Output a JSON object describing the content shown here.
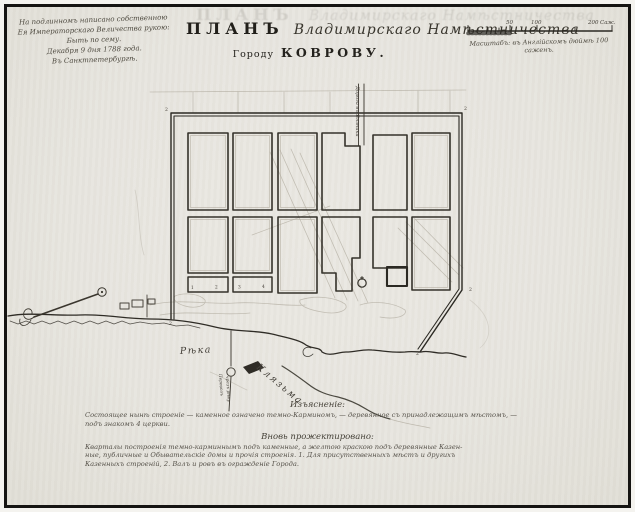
{
  "colors": {
    "paper": "#e9e7e1",
    "ink": "#2b2923",
    "faint": "#a39d8f",
    "frame": "#151412"
  },
  "imperial_note": {
    "lines": [
      "На подлинномъ написано собственною",
      "Ея Императорскаго Величества рукою:",
      "Быть по сему.",
      "Декабря 9 дня 1788 года.",
      "Въ Санктпетербургѣ."
    ]
  },
  "title": {
    "plan": "ПЛАНЪ",
    "script": "Владимирскаго Намѣстничества",
    "city_prefix": "Городу",
    "city": "КОВРОВУ."
  },
  "scale_bar": {
    "labels": [
      "50",
      "100",
      "200"
    ],
    "unit": "Саж.",
    "caption": "Масштабъ: въ Англійскомъ дюймѣ 100 саженъ."
  },
  "map_labels": {
    "road_north": "Дорога въ Вязники",
    "river_word": "Рѣка",
    "river_name": "Клязьма",
    "ferry_line1": "Перевозъ",
    "ferry_line2": "чрезъ рѣку",
    "corner_mark": "2",
    "block_numbers": [
      "1",
      "2",
      "3",
      "4"
    ]
  },
  "legend": {
    "heading_existing": "Изъясненіе:",
    "existing": [
      "Состоящее нынѣ строеніе — каменное означено темно-Карминомъ, — деревянное съ принадлежащимъ мѣстомъ, —",
      "подъ знакомъ 4 церкви."
    ],
    "heading_projected": "Вновь прожектировано:",
    "projected": [
      "Кварталы построенія темно-карминнымъ подъ каменные, а желтою краскою подъ деревянные Казен-",
      "ные, публичные и Обывательскіе домы и прочія строенія. 1. Для присутственныхъ мѣстъ и другихъ",
      "Казенныхъ строеній, 2. Валъ и ровъ въ огражденіе Города."
    ]
  }
}
